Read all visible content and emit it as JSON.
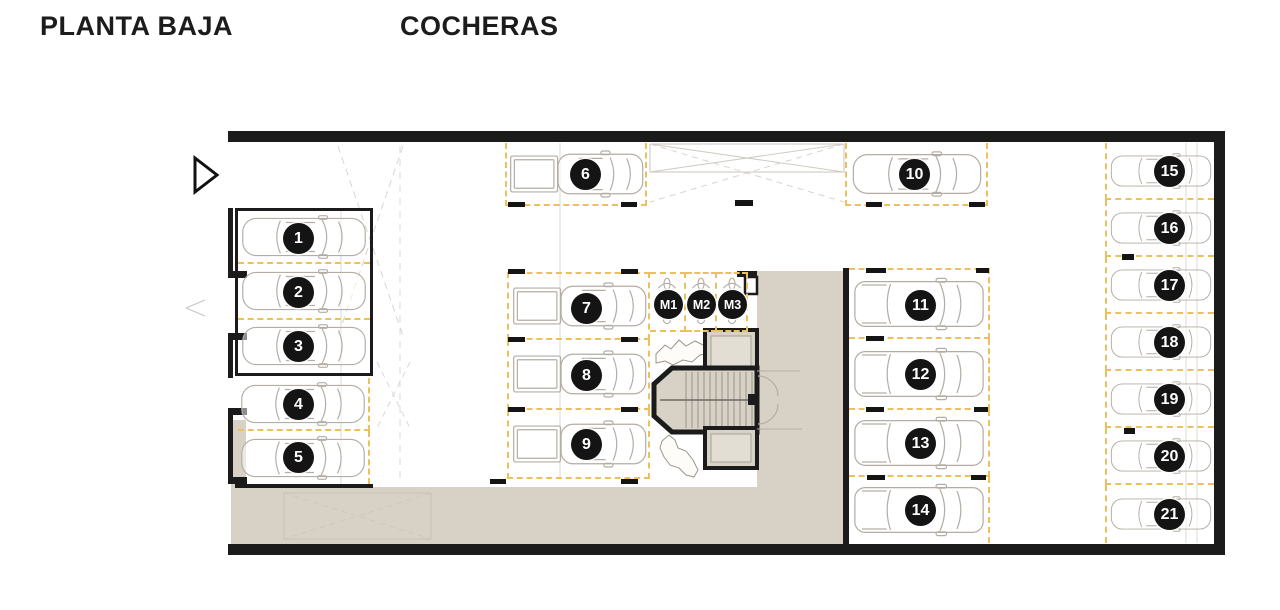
{
  "page": {
    "title_left": "PLANTA BAJA",
    "title_right": "COCHERAS"
  },
  "colors": {
    "wall": "#1b1b1b",
    "dash": "#ecc05e",
    "beige": "#d8d2c6",
    "car": "#b4ada4",
    "faint": "#d8d5cf"
  },
  "plan": {
    "floor_label": "PLANTA BAJA",
    "area_label": "COCHERAS",
    "car_spot_count": 21,
    "moto_spot_count": 3
  },
  "spots": [
    {
      "label": "1",
      "x": 238,
      "y": 212,
      "w": 132,
      "h": 52,
      "borders": [
        "bottom"
      ],
      "vehicle": "sedan",
      "facing": "right",
      "vw": 127,
      "vh": 44,
      "cx": 0.46
    },
    {
      "label": "2",
      "x": 238,
      "y": 264,
      "w": 132,
      "h": 56,
      "borders": [
        "bottom"
      ],
      "vehicle": "sedan",
      "facing": "right",
      "vw": 127,
      "vh": 44,
      "cx": 0.46
    },
    {
      "label": "3",
      "x": 238,
      "y": 320,
      "w": 132,
      "h": 52,
      "borders": [],
      "vehicle": "sedan",
      "facing": "right",
      "vw": 127,
      "vh": 44,
      "cx": 0.46
    },
    {
      "label": "4",
      "x": 238,
      "y": 378,
      "w": 132,
      "h": 53,
      "borders": [
        "right",
        "bottom"
      ],
      "vehicle": "sedan",
      "facing": "right",
      "vw": 127,
      "vh": 44,
      "cx": 0.46
    },
    {
      "label": "5",
      "x": 238,
      "y": 431,
      "w": 132,
      "h": 53,
      "borders": [
        "right"
      ],
      "vehicle": "sedan",
      "facing": "right",
      "vw": 127,
      "vh": 44,
      "cx": 0.46
    },
    {
      "label": "6",
      "x": 505,
      "y": 143,
      "w": 142,
      "h": 63,
      "borders": [
        "left",
        "right",
        "bottom"
      ],
      "vehicle": "pickup",
      "facing": "left",
      "vw": 138,
      "vh": 52,
      "cx": 0.55
    },
    {
      "label": "7",
      "x": 507,
      "y": 272,
      "w": 143,
      "h": 68,
      "borders": [
        "left",
        "top",
        "right",
        "bottom"
      ],
      "vehicle": "pickup",
      "facing": "left",
      "vw": 138,
      "vh": 52,
      "cx": 0.54
    },
    {
      "label": "8",
      "x": 507,
      "y": 340,
      "w": 143,
      "h": 70,
      "borders": [
        "left",
        "right",
        "bottom"
      ],
      "vehicle": "pickup",
      "facing": "left",
      "vw": 138,
      "vh": 52,
      "cx": 0.54
    },
    {
      "label": "9",
      "x": 507,
      "y": 410,
      "w": 143,
      "h": 69,
      "borders": [
        "left",
        "right",
        "bottom"
      ],
      "vehicle": "pickup",
      "facing": "left",
      "vw": 138,
      "vh": 52,
      "cx": 0.54
    },
    {
      "label": "10",
      "x": 845,
      "y": 143,
      "w": 143,
      "h": 63,
      "borders": [
        "left",
        "right",
        "bottom"
      ],
      "vehicle": "sedan",
      "facing": "right",
      "vw": 132,
      "vh": 46,
      "cx": 0.47
    },
    {
      "label": "11",
      "x": 849,
      "y": 268,
      "w": 141,
      "h": 71,
      "borders": [
        "top",
        "right",
        "bottom"
      ],
      "vehicle": "wagon",
      "facing": "right",
      "vw": 133,
      "vh": 54,
      "cx": 0.51
    },
    {
      "label": "12",
      "x": 849,
      "y": 339,
      "w": 141,
      "h": 71,
      "borders": [
        "right",
        "bottom"
      ],
      "vehicle": "wagon",
      "facing": "right",
      "vw": 133,
      "vh": 54,
      "cx": 0.51
    },
    {
      "label": "13",
      "x": 849,
      "y": 410,
      "w": 141,
      "h": 67,
      "borders": [
        "right",
        "bottom"
      ],
      "vehicle": "wagon",
      "facing": "right",
      "vw": 133,
      "vh": 54,
      "cx": 0.51
    },
    {
      "label": "14",
      "x": 849,
      "y": 477,
      "w": 141,
      "h": 66,
      "borders": [
        "right"
      ],
      "vehicle": "wagon",
      "facing": "right",
      "vw": 133,
      "vh": 54,
      "cx": 0.51
    },
    {
      "label": "15",
      "x": 1105,
      "y": 143,
      "w": 109,
      "h": 57,
      "borders": [
        "left",
        "bottom"
      ],
      "vehicle": "sedan",
      "facing": "right",
      "vw": 103,
      "vh": 46,
      "cx": 0.57
    },
    {
      "label": "16",
      "x": 1105,
      "y": 200,
      "w": 109,
      "h": 57,
      "borders": [
        "left",
        "bottom"
      ],
      "vehicle": "sedan",
      "facing": "right",
      "vw": 103,
      "vh": 46,
      "cx": 0.57
    },
    {
      "label": "17",
      "x": 1105,
      "y": 257,
      "w": 109,
      "h": 57,
      "borders": [
        "left",
        "bottom"
      ],
      "vehicle": "sedan",
      "facing": "right",
      "vw": 103,
      "vh": 46,
      "cx": 0.57
    },
    {
      "label": "18",
      "x": 1105,
      "y": 314,
      "w": 109,
      "h": 57,
      "borders": [
        "left",
        "bottom"
      ],
      "vehicle": "sedan",
      "facing": "right",
      "vw": 103,
      "vh": 46,
      "cx": 0.57
    },
    {
      "label": "19",
      "x": 1105,
      "y": 371,
      "w": 109,
      "h": 57,
      "borders": [
        "left",
        "bottom"
      ],
      "vehicle": "sedan",
      "facing": "right",
      "vw": 103,
      "vh": 46,
      "cx": 0.57
    },
    {
      "label": "20",
      "x": 1105,
      "y": 428,
      "w": 109,
      "h": 57,
      "borders": [
        "left",
        "bottom"
      ],
      "vehicle": "sedan",
      "facing": "right",
      "vw": 103,
      "vh": 46,
      "cx": 0.57
    },
    {
      "label": "21",
      "x": 1105,
      "y": 485,
      "w": 109,
      "h": 58,
      "borders": [
        "left"
      ],
      "vehicle": "sedan",
      "facing": "right",
      "vw": 103,
      "vh": 46,
      "cx": 0.57
    },
    {
      "label": "M1",
      "x": 650,
      "y": 272,
      "w": 36,
      "h": 60,
      "borders": [
        "top",
        "right",
        "bottom"
      ],
      "vehicle": "moto",
      "facing": "up",
      "vw": 26,
      "vh": 54,
      "cx": 0.5
    },
    {
      "label": "M2",
      "x": 686,
      "y": 272,
      "w": 31,
      "h": 60,
      "borders": [
        "top",
        "right",
        "bottom"
      ],
      "vehicle": "moto",
      "facing": "up",
      "vw": 26,
      "vh": 54,
      "cx": 0.5
    },
    {
      "label": "M3",
      "x": 717,
      "y": 272,
      "w": 31,
      "h": 60,
      "borders": [
        "top",
        "right",
        "bottom"
      ],
      "vehicle": "moto",
      "facing": "up",
      "vw": 26,
      "vh": 54,
      "cx": 0.5
    }
  ],
  "ticks": [
    [
      508,
      202,
      17,
      5
    ],
    [
      621,
      202,
      16,
      5
    ],
    [
      735,
      200,
      18,
      6
    ],
    [
      866,
      202,
      16,
      5
    ],
    [
      969,
      202,
      16,
      5
    ],
    [
      508,
      269,
      17,
      5
    ],
    [
      621,
      269,
      17,
      5
    ],
    [
      508,
      337,
      17,
      5
    ],
    [
      621,
      337,
      17,
      5
    ],
    [
      508,
      407,
      17,
      5
    ],
    [
      621,
      407,
      17,
      5
    ],
    [
      490,
      479,
      16,
      5
    ],
    [
      621,
      479,
      17,
      5
    ],
    [
      866,
      268,
      20,
      5
    ],
    [
      976,
      268,
      13,
      5
    ],
    [
      866,
      336,
      18,
      5
    ],
    [
      866,
      407,
      18,
      5
    ],
    [
      974,
      407,
      14,
      5
    ],
    [
      867,
      475,
      18,
      5
    ],
    [
      971,
      475,
      15,
      5
    ],
    [
      1122,
      254,
      12,
      6
    ],
    [
      1124,
      428,
      11,
      6
    ]
  ]
}
